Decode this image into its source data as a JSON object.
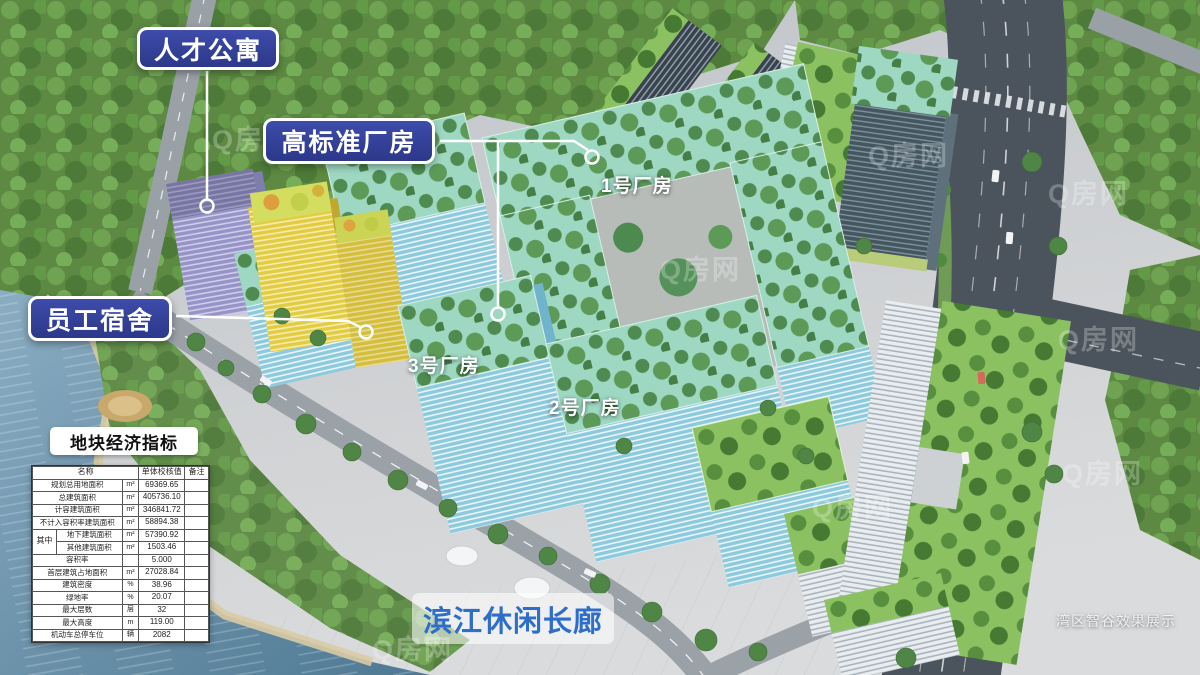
{
  "annotations": {
    "talent_apartment": "人才公寓",
    "high_standard_factory": "高标准厂房",
    "staff_dormitory": "员工宿舍",
    "factory_1": "1号厂房",
    "factory_2": "2号厂房",
    "factory_3": "3号厂房",
    "riverside_corridor": "滨江休闲长廊",
    "caption": "湾区智谷效果展示",
    "watermark": "Q房网"
  },
  "indicator_table": {
    "title": "地块经济指标",
    "headers": {
      "name": "名称",
      "value": "单体校核值",
      "remark": "备注"
    },
    "rows": [
      {
        "name": "规划总用地面积",
        "unit": "m²",
        "value": "69369.65"
      },
      {
        "name": "总建筑面积",
        "unit": "m²",
        "value": "405736.10"
      },
      {
        "name": "计容建筑面积",
        "unit": "m²",
        "value": "346841.72"
      },
      {
        "name": "不计入容积率建筑面积",
        "unit": "m²",
        "value": "58894.38"
      },
      {
        "name": "地下建筑面积",
        "unit": "m²",
        "value": "57390.92",
        "group": "其中"
      },
      {
        "name": "其他建筑面积",
        "unit": "m²",
        "value": "1503.46",
        "in_group": true
      },
      {
        "name": "容积率",
        "unit": "",
        "value": "5.000"
      },
      {
        "name": "首层建筑占地面积",
        "unit": "m²",
        "value": "27028.84"
      },
      {
        "name": "建筑密度",
        "unit": "%",
        "value": "38.96"
      },
      {
        "name": "绿地率",
        "unit": "%",
        "value": "20.07"
      },
      {
        "name": "最大层数",
        "unit": "层",
        "value": "32"
      },
      {
        "name": "最大高度",
        "unit": "m",
        "value": "119.00"
      },
      {
        "name": "机动车总停车位",
        "unit": "辆",
        "value": "2082"
      }
    ]
  },
  "colors": {
    "label_bg": "#323f96",
    "label_border": "#ffffff",
    "riverside_text": "#2e6ec9",
    "water": "#5d8aa6",
    "factory_facade": "#8ecadd",
    "factory_roof": "#9ed8c2",
    "dorm_facade": "#e2cc45",
    "apartment_facade": "#9693c7"
  }
}
